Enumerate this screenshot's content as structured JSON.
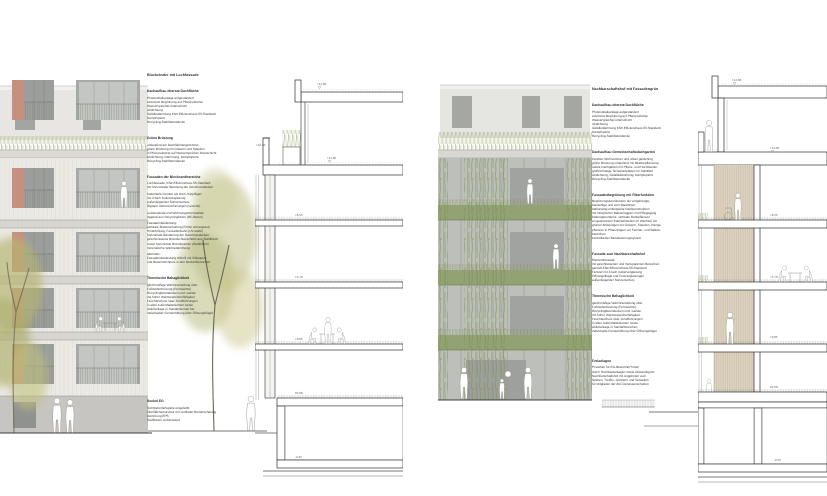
{
  "colors": {
    "salmon": "#c68f7e",
    "wood": "#edebe6",
    "concrete": "#c6c5c2",
    "glass-dark": "#9b9e9b",
    "glass-light": "#c3c6c2",
    "green-facade": "#93a272",
    "grass": "#8a9a60",
    "tan-structure": "#dcd3c2",
    "cut-line": "#2f2f2f"
  },
  "panels": {
    "left": {
      "annotations": {
        "title": "Blockränder mit Lochfassade",
        "sections": [
          {
            "heading": "Dachaufbau oberste Dachfläche",
            "lines": [
              "Photovoltaikanlage aufgeständert",
              "extensive Begrünung auf Pflanzsubstrat",
              "Wasserspeicher-Dränschicht",
              "Abdichtung",
              "Gefälledämmung KfW-Effizienzhaus-55-Standard",
              "Dampfsperre",
              "Recycling-Stahlbetondecke"
            ]
          },
          {
            "heading": "Grüne Brüstung",
            "lines": [
              "umlaufend am Dachflächengeschoss",
              "grüne Brüstung mit Gräsern und Stauden",
              "in Pflanzsubstrat auf Wasserspeicher-Dränschicht",
              "Abdichtung, Dämmung, Dampfsperre",
              "Recycling-Stahlbetondecke"
            ]
          },
          {
            "heading": "Fassaden der Blockrandbereiche",
            "lines": [
              "Lochfassade, KfW-Effizienzhaus-55-Standard",
              "mit horizontaler Betonung der Geschossdecken",
              "",
              "bodentiefe Fenster als Dreh-/Kippflügel",
              "mit 3-fach Isolierverglasung",
              "außenliegender Sonnenschutz",
              "filigrane Absturzsicherungen (verzinkt)",
              "",
              "Außenwände und Wohnungstrennwände",
              "tragend aus Recyclingbeton (RC-Beton)",
              "",
              "Fassadenbekleidung:",
              "vertikale Bretterschalung (Fichte vorvergraut)",
              "Hinterlüftung, Fassadenbahn (UV-stabil)",
              "horizontale Bänderung der Geschossdecken",
              "geschossweise Brandschutzschotts aus Stahlblech",
              "sowie horizontale Brandsperren (Stahlblech)",
              "mineralische Wärmedämmung",
              "",
              "alternativ:",
              "Fassadenbekleidung WDVS mit Silikatputz",
              "und Besenstrichputz in den Deckenbereichen"
            ]
          },
          {
            "heading": "Thermische Behaglichkeit",
            "lines": [
              "gleichmäßige Wärmeverteilung über",
              "Fußbodenheizung (Fernwärme)",
              "Recyclingbetondecken und -wände",
              "mit hoher Wärmespeicherfähigkeit",
              "Feuchteschutz über Zuluftführungen",
              "in allen Aufenthaltsräumen sowie",
              "Abluftanlage in Sanitärräumen bei",
              "individueller Fensterlüftung über Öffnungsflügel"
            ]
          },
          {
            "heading": "Sockel EG",
            "lines": [
              "Sichtbetonfertigteile eingefärbt",
              "Oberflächenstruktur mit vertikaler Bretterschalung",
              "Dämmung EPS",
              "Stahlbeton-Außenwand"
            ]
          }
        ]
      },
      "section": {
        "levels": [
          "+14.80",
          "+12.20",
          "+11.50",
          "+8.55",
          "+5.70",
          "+2.85",
          "±0.00",
          "-2.45"
        ]
      }
    },
    "right": {
      "annotations": {
        "title": "Nachbarschaftshof mit Fassadengrün",
        "sections": [
          {
            "heading": "Dachaufbau oberste Dachfläche",
            "lines": [
              "Photovoltaikanlage aufgeständert",
              "extensive Begrünung auf Pflanzsubstrat",
              "Wasserspeicher-Dränschicht",
              "Abdichtung",
              "Gefälledämmung KfW-Effizienzhaus-55-Standard",
              "Dampfsperre",
              "Recycling-Stahlbetondecke"
            ]
          },
          {
            "heading": "Dachaufbau Gemeinschaftsdachgarten",
            "lines": [
              "Outdoor-Wohnzimmer und urban gardening",
              "grüne Brüstung umlaufend mit Beetbepflanzung",
              "solare Dachgärten mit Pflanz- und Hochbeeten",
              "großformatige Terrassenplatten im Splittbett",
              "Abdichtung, Gefälledämmung, Dampfsperre",
              "Recycling-Stahlbetondecke"
            ]
          },
          {
            "heading": "Fassadenbegrünung mit Filterfunktion",
            "lines": [
              "Begrünungskonstruktion als vorgehängte,",
              "bandartige und vom Baukörper",
              "balkonartig entkoppelte Rankkonstruktion",
              "mit integrierten Balkonloggien und Pflegegang",
              "bodengebundene, vertikale Rankpflanzen",
              "an gespannten Edelstahlseilen im Wechsel mit",
              "grünen Brüstungen mit Gräsern, Stauden, Hänge-",
              "pflanzen in Pflanztrögen vor Fenster- und Balkon-",
              "bereichen",
              "kontrolliertes Bewässerungssystem"
            ]
          },
          {
            "heading": "Fassade zum Nachbarschaftshof",
            "lines": [
              "Elementfassade",
              "mit geschlossenen und transparenten Bereichen",
              "gemäß KfW-Effizienzhaus-55-Standard",
              "Fenster mit 3-fach Isolierverglasung",
              "Öffnungsflügel und Festverglasungen",
              "außenliegender Sonnenschutz"
            ]
          },
          {
            "heading": "Thermische Behaglichkeit",
            "lines": [
              "gleichmäßige Wärmeverteilung über",
              "Fußbodenheizung (Fernwärme)",
              "Recyclingbetondecken und -wände",
              "mit hoher Wärmespeicherfähigkeit",
              "Feuchteschutz über Zuluftführungen",
              "in allen Aufenthaltsräumen sowie",
              "Abluftanlage in Sanitärbereichen",
              "individuelle Fensterlüftung über Öffnungsflügel"
            ]
          },
          {
            "heading": "Freianlagen",
            "lines": [
              "Privatheit für EG-Bewohner*innen",
              "durch Hochbeetanlagen sowie Abstandsgrün",
              "Nachbarschaftshof mit Angeboten zum",
              "Spielen, Treffen, Gärtnern und Verweilen",
              "für Mitglieder der drei Genossenschaften"
            ]
          }
        ]
      },
      "section": {
        "levels": [
          "+14.80",
          "+11.50",
          "+8.55",
          "+5.70",
          "+2.85",
          "±0.00",
          "-2.45"
        ]
      }
    }
  }
}
